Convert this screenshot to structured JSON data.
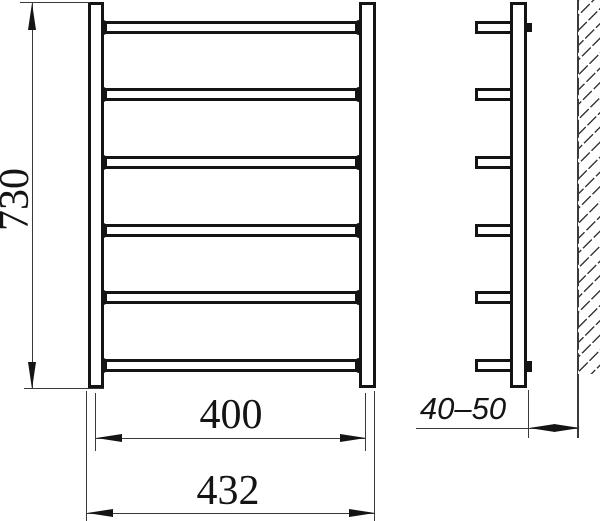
{
  "drawing": {
    "subject": "ladder-towel-rail-two-view-dimension-drawing",
    "labels": {
      "height": "730",
      "inner_width": "400",
      "overall_width": "432",
      "wall_offset": "40–50"
    },
    "structure": {
      "rail_count": 6,
      "side_rung_count": 6,
      "wall_bracket_stubs": 2,
      "wall_hatched": true
    },
    "colors": {
      "line": "#141414",
      "thin_line": "#3a3a3a",
      "background": "#ffffff"
    }
  }
}
